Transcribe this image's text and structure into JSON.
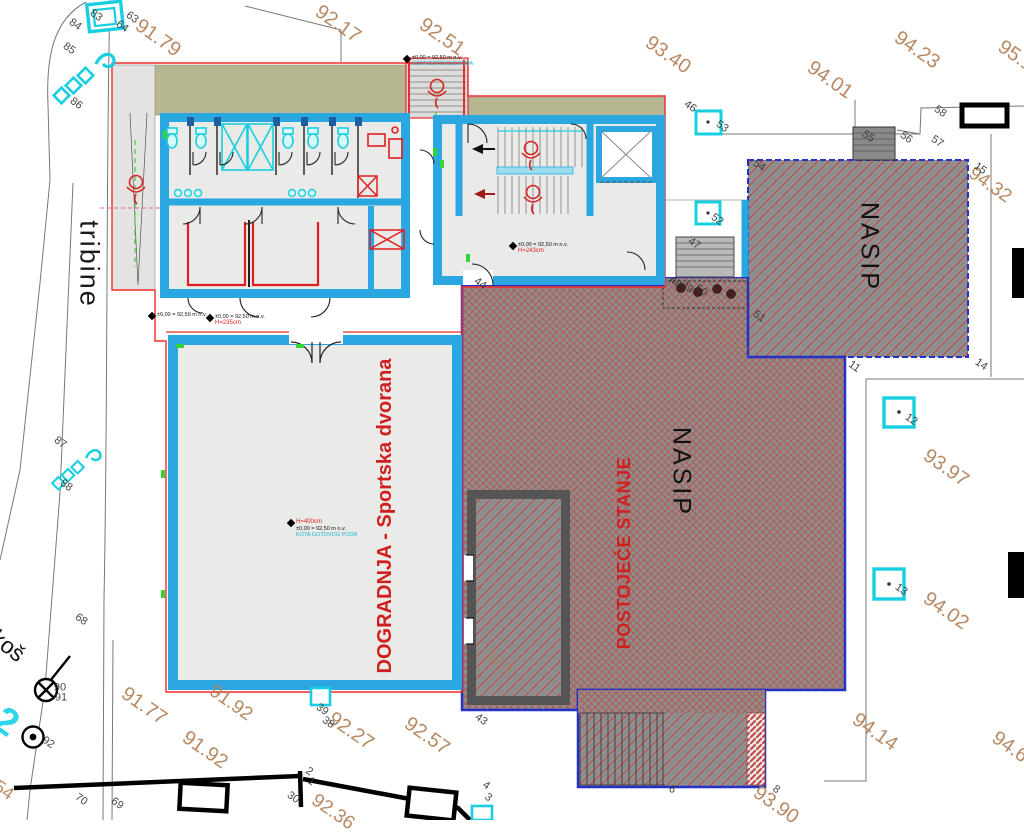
{
  "areas": {
    "tribine": "tribine",
    "dogradnja": "DOGRADNJA - Sportska dvorana",
    "postojece": "POSTOJEĆE STANJE",
    "nasip_center": "NASIP",
    "nasip_right": "NASIP",
    "kos": "koš",
    "cyan_partial": "2"
  },
  "elevation_labels": [
    {
      "t": "91.79",
      "x": 158,
      "y": 38,
      "s": 20
    },
    {
      "t": "92.17",
      "x": 338,
      "y": 24,
      "s": 20
    },
    {
      "t": "92.51",
      "x": 442,
      "y": 37,
      "s": 20
    },
    {
      "t": "93.40",
      "x": 668,
      "y": 55,
      "s": 20
    },
    {
      "t": "94.01",
      "x": 830,
      "y": 80,
      "s": 20
    },
    {
      "t": "94.23",
      "x": 917,
      "y": 50,
      "s": 20
    },
    {
      "t": "95.1",
      "x": 1016,
      "y": 56,
      "s": 20
    },
    {
      "t": "94.32",
      "x": 990,
      "y": 185,
      "s": 19
    },
    {
      "t": "93.97",
      "x": 946,
      "y": 468,
      "s": 20
    },
    {
      "t": "94.02",
      "x": 946,
      "y": 611,
      "s": 20
    },
    {
      "t": "94.14",
      "x": 875,
      "y": 732,
      "s": 20
    },
    {
      "t": "94.6",
      "x": 1010,
      "y": 747,
      "s": 20
    },
    {
      "t": "93.90",
      "x": 776,
      "y": 805,
      "s": 20
    },
    {
      "t": "91.77",
      "x": 144,
      "y": 706,
      "s": 20
    },
    {
      "t": "91.92",
      "x": 231,
      "y": 703,
      "s": 19
    },
    {
      "t": "91.92",
      "x": 205,
      "y": 750,
      "s": 20
    },
    {
      "t": "92.27",
      "x": 351,
      "y": 731,
      "s": 20
    },
    {
      "t": "92.57",
      "x": 427,
      "y": 736,
      "s": 20
    },
    {
      "t": "92.36",
      "x": 333,
      "y": 812,
      "s": 19
    },
    {
      "t": "54",
      "x": 4,
      "y": 790,
      "s": 18
    },
    {
      "t": "94.66",
      "x": 735,
      "y": 344,
      "s": 16,
      "o": 0.35
    },
    {
      "t": "94.45",
      "x": 903,
      "y": 294,
      "s": 16,
      "o": 0.3
    },
    {
      "t": "96.03",
      "x": 694,
      "y": 656,
      "s": 16,
      "o": 0.4
    },
    {
      "t": "92.5",
      "x": 500,
      "y": 663,
      "s": 15,
      "o": 0.5
    }
  ],
  "survey_numbers": [
    {
      "t": "83",
      "x": 96,
      "y": 16
    },
    {
      "t": "84",
      "x": 75,
      "y": 25
    },
    {
      "t": "63",
      "x": 132,
      "y": 18
    },
    {
      "t": "64",
      "x": 122,
      "y": 27
    },
    {
      "t": "85",
      "x": 69,
      "y": 49
    },
    {
      "t": "86",
      "x": 76,
      "y": 104
    },
    {
      "t": "87",
      "x": 60,
      "y": 443
    },
    {
      "t": "88",
      "x": 66,
      "y": 486
    },
    {
      "t": "68",
      "x": 81,
      "y": 620
    },
    {
      "t": "90",
      "x": 60,
      "y": 688,
      "r": 0
    },
    {
      "t": "91",
      "x": 61,
      "y": 698,
      "r": 0
    },
    {
      "t": "92",
      "x": 48,
      "y": 743
    },
    {
      "t": "70",
      "x": 81,
      "y": 800
    },
    {
      "t": "69",
      "x": 117,
      "y": 804
    },
    {
      "t": "30",
      "x": 293,
      "y": 798
    },
    {
      "t": "2",
      "x": 309,
      "y": 772
    },
    {
      "t": "1",
      "x": 311,
      "y": 782
    },
    {
      "t": "39",
      "x": 322,
      "y": 710
    },
    {
      "t": "38",
      "x": 328,
      "y": 723
    },
    {
      "t": "43",
      "x": 481,
      "y": 720
    },
    {
      "t": "44",
      "x": 480,
      "y": 284
    },
    {
      "t": "46",
      "x": 690,
      "y": 107
    },
    {
      "t": "53",
      "x": 722,
      "y": 127
    },
    {
      "t": "52",
      "x": 717,
      "y": 220
    },
    {
      "t": "47",
      "x": 694,
      "y": 244
    },
    {
      "t": "48",
      "x": 675,
      "y": 283
    },
    {
      "t": "49",
      "x": 687,
      "y": 288
    },
    {
      "t": "50",
      "x": 701,
      "y": 291
    },
    {
      "t": "51",
      "x": 759,
      "y": 317
    },
    {
      "t": "54",
      "x": 759,
      "y": 166
    },
    {
      "t": "55",
      "x": 868,
      "y": 137
    },
    {
      "t": "56",
      "x": 906,
      "y": 138
    },
    {
      "t": "57",
      "x": 937,
      "y": 142
    },
    {
      "t": "58",
      "x": 940,
      "y": 112
    },
    {
      "t": "15",
      "x": 980,
      "y": 169
    },
    {
      "t": "14",
      "x": 981,
      "y": 365
    },
    {
      "t": "12",
      "x": 911,
      "y": 420
    },
    {
      "t": "13",
      "x": 901,
      "y": 590
    },
    {
      "t": "11",
      "x": 854,
      "y": 367
    },
    {
      "t": "6",
      "x": 672,
      "y": 790
    },
    {
      "t": "8",
      "x": 776,
      "y": 790
    },
    {
      "t": "4",
      "x": 486,
      "y": 786
    },
    {
      "t": "3",
      "x": 488,
      "y": 798
    }
  ],
  "annotations": [
    {
      "x": 407,
      "y": 59,
      "black": "±0,00 = 92,50 m n.v.",
      "cyan": "KOTA GOTOVOG PODA"
    },
    {
      "x": 152,
      "y": 316,
      "black": "±0,00 = 92,50 m n.v."
    },
    {
      "x": 210,
      "y": 318,
      "black": "±0,00 = 92,50 m n.v.",
      "red": "H=235cm"
    },
    {
      "x": 513,
      "y": 246,
      "black": "±0,00 = 92,50 m n.v.",
      "red": "H=243cm"
    },
    {
      "x": 291,
      "y": 523,
      "black": "±0,00 = 92,50 m n.v.",
      "cyan": "KOTA GOTOVOG PODA",
      "red": "H=400cm",
      "redAbove": true
    }
  ],
  "colors": {
    "blue_wall": "#2aa7e0",
    "red": "#e02020",
    "cyan": "#18cfe2",
    "olive": "#b6b692",
    "hatch_red": "#c64848",
    "label_brown": "#b5835a",
    "blue_border": "#2431c8"
  }
}
